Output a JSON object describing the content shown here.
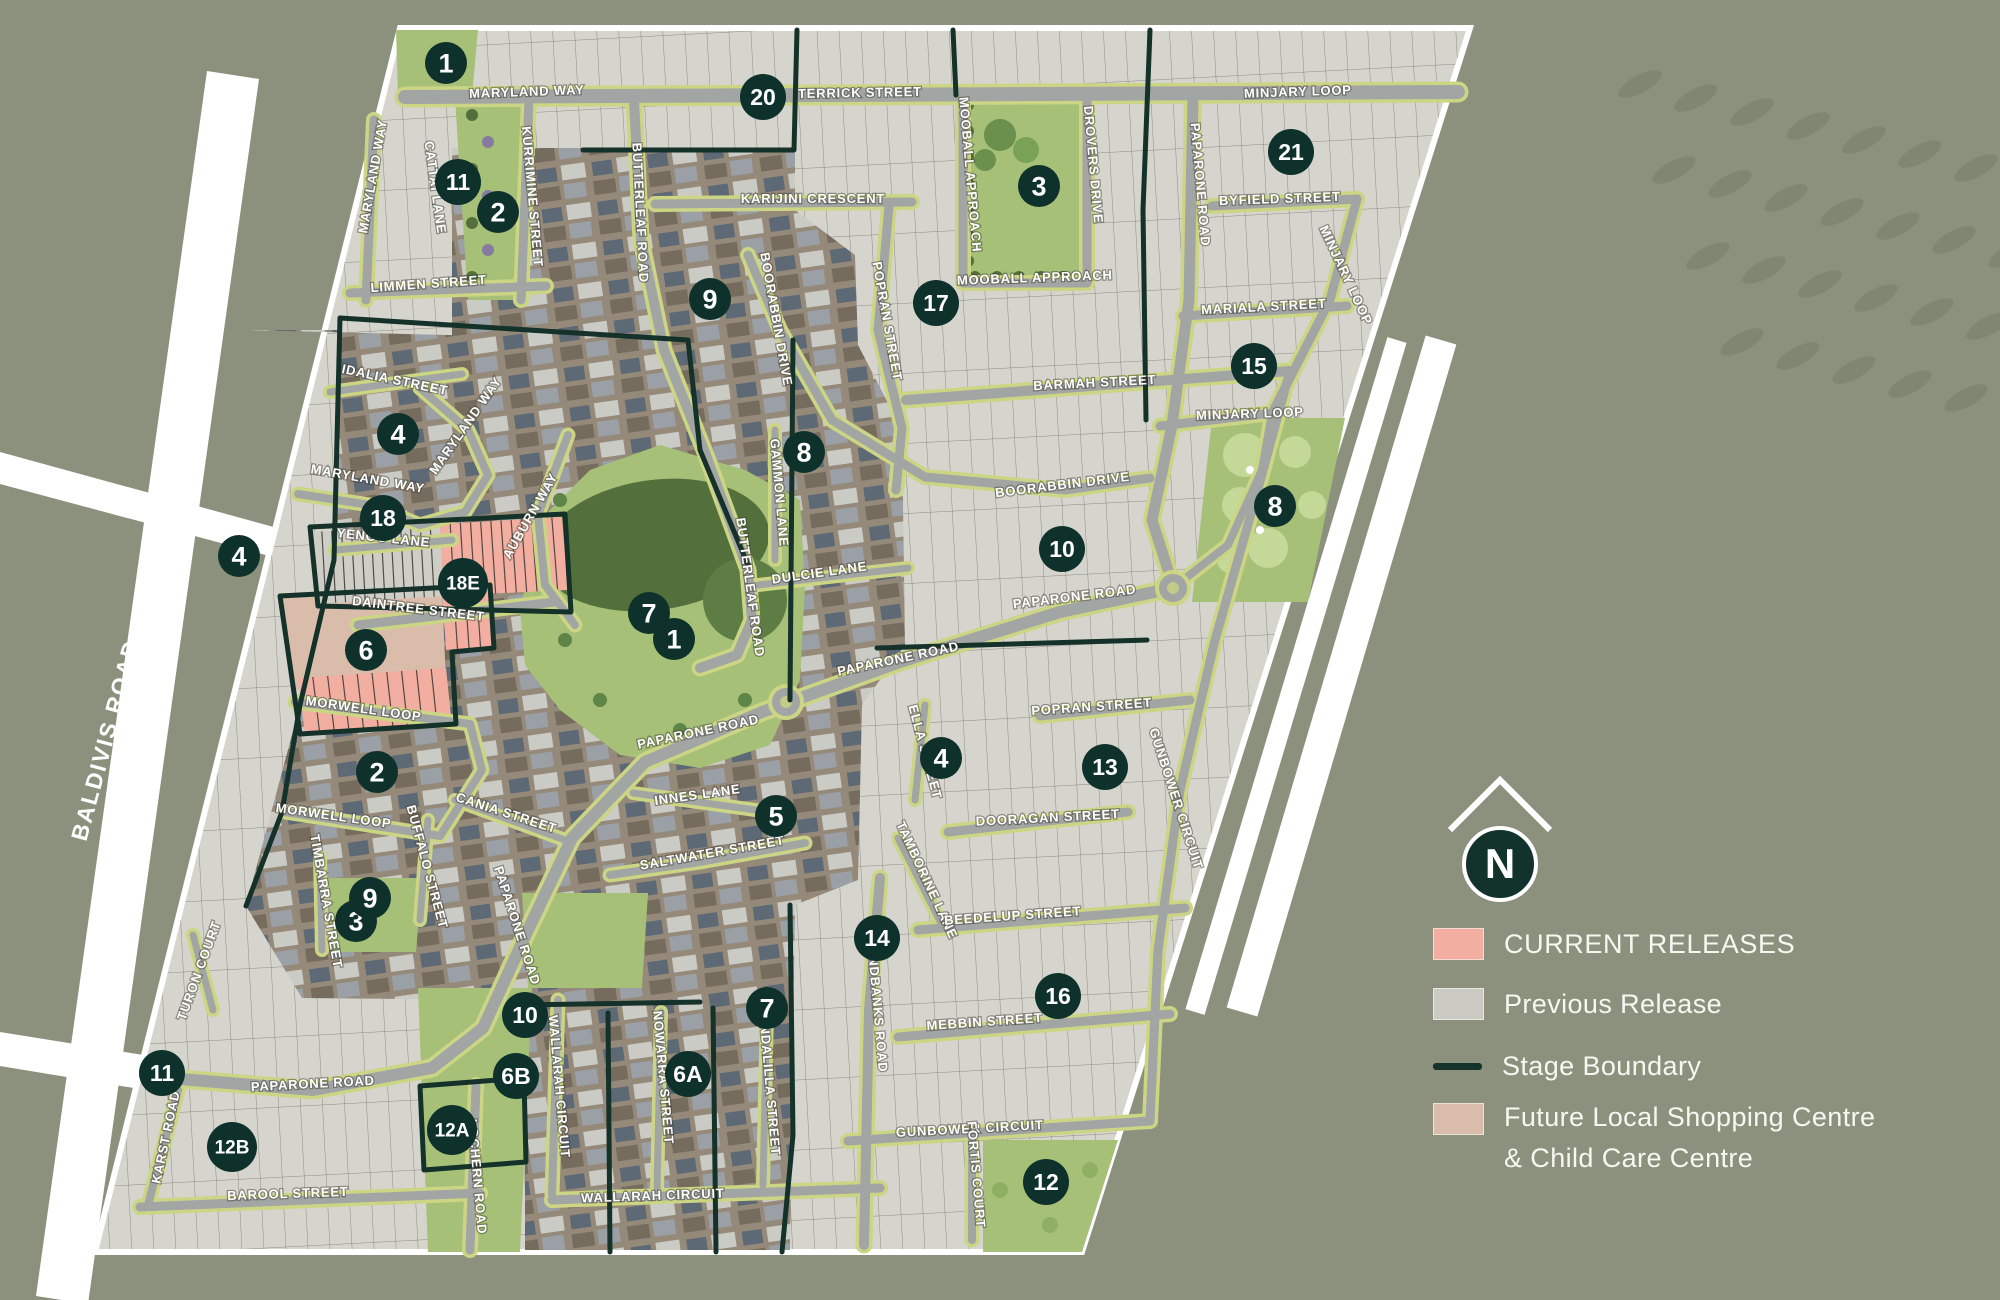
{
  "legend": {
    "items": [
      {
        "label": "CURRENT RELEASES",
        "color": "#F2AEA0",
        "type": "fill"
      },
      {
        "label": "Previous Release",
        "color": "#CBCBC3",
        "type": "fill"
      },
      {
        "label": "Stage Boundary",
        "color": "#16332B",
        "type": "line"
      },
      {
        "line1": "Future Local Shopping Centre",
        "line2": "& Child Care Centre",
        "color": "#D9BCA9",
        "type": "fill"
      }
    ]
  },
  "compass": {
    "letter": "N"
  },
  "external_roads": [
    {
      "label": "BALDIVIS ROAD",
      "x": 113,
      "y": 742,
      "r": -75
    },
    {
      "label": "KWINANA FREEWAY",
      "x": 1333,
      "y": 718,
      "r": -72
    }
  ],
  "map": {
    "streets": [
      {
        "label": "MARYLAND WAY",
        "x": 527,
        "y": 96,
        "r": -2
      },
      {
        "label": "TERRICK STREET",
        "x": 860,
        "y": 97,
        "r": -1
      },
      {
        "label": "MINJARY LOOP",
        "x": 1298,
        "y": 96,
        "r": -2
      },
      {
        "label": "MARYLAND WAY",
        "x": 377,
        "y": 177,
        "r": -80
      },
      {
        "label": "CATTAI LANE",
        "x": 431,
        "y": 188,
        "r": 82
      },
      {
        "label": "KURRIMINE STREET",
        "x": 528,
        "y": 197,
        "r": 85
      },
      {
        "label": "BUTTERLEAF ROAD",
        "x": 636,
        "y": 213,
        "r": 87
      },
      {
        "label": "LIMMEN STREET",
        "x": 429,
        "y": 288,
        "r": -4
      },
      {
        "label": "KARIJINI CRESCENT",
        "x": 813,
        "y": 203,
        "r": 0
      },
      {
        "label": "MOOBALL APPROACH",
        "x": 966,
        "y": 175,
        "r": 85
      },
      {
        "label": "DROVERS DRIVE",
        "x": 1089,
        "y": 165,
        "r": 85
      },
      {
        "label": "PAPARONE ROAD",
        "x": 1196,
        "y": 185,
        "r": 85
      },
      {
        "label": "MOOBALL APPROACH",
        "x": 1035,
        "y": 282,
        "r": -2
      },
      {
        "label": "BYFIELD STREET",
        "x": 1280,
        "y": 203,
        "r": -2
      },
      {
        "label": "MARIALA STREET",
        "x": 1264,
        "y": 311,
        "r": -3
      },
      {
        "label": "MINJARY LOOP",
        "x": 1342,
        "y": 277,
        "r": 65
      },
      {
        "label": "BARMAH STREET",
        "x": 1095,
        "y": 387,
        "r": -3
      },
      {
        "label": "MINJARY LOOP",
        "x": 1250,
        "y": 418,
        "r": -2
      },
      {
        "label": "POPRAN STREET",
        "x": 883,
        "y": 322,
        "r": 80
      },
      {
        "label": "BOORABBIN DRIVE",
        "x": 772,
        "y": 320,
        "r": 80
      },
      {
        "label": "BOORABBIN DRIVE",
        "x": 1063,
        "y": 489,
        "r": -7
      },
      {
        "label": "GAMMON LANE",
        "x": 775,
        "y": 493,
        "r": 85
      },
      {
        "label": "DULCIE LANE",
        "x": 820,
        "y": 577,
        "r": -8
      },
      {
        "label": "PAPARONE ROAD",
        "x": 1075,
        "y": 601,
        "r": -7
      },
      {
        "label": "BUTTERLEAF ROAD",
        "x": 746,
        "y": 588,
        "r": 82
      },
      {
        "label": "IDALIA STREET",
        "x": 394,
        "y": 384,
        "r": 12
      },
      {
        "label": "MARYLAND WAY",
        "x": 469,
        "y": 428,
        "r": -55
      },
      {
        "label": "MARYLAND WAY",
        "x": 367,
        "y": 483,
        "r": 10
      },
      {
        "label": "AUBURN WAY",
        "x": 534,
        "y": 518,
        "r": -60
      },
      {
        "label": "YENGO LANE",
        "x": 383,
        "y": 542,
        "r": 6
      },
      {
        "label": "DAINTREE STREET",
        "x": 418,
        "y": 613,
        "r": 7
      },
      {
        "label": "PAPARONE ROAD",
        "x": 899,
        "y": 663,
        "r": -12
      },
      {
        "label": "POPRAN STREET",
        "x": 1092,
        "y": 711,
        "r": -4
      },
      {
        "label": "PAPARONE ROAD",
        "x": 699,
        "y": 736,
        "r": -12
      },
      {
        "label": "INNES LANE",
        "x": 698,
        "y": 799,
        "r": -8
      },
      {
        "label": "ELLA STREET",
        "x": 921,
        "y": 753,
        "r": 75
      },
      {
        "label": "DOORAGAN STREET",
        "x": 1048,
        "y": 822,
        "r": -3
      },
      {
        "label": "MORWELL LOOP",
        "x": 363,
        "y": 713,
        "r": 8
      },
      {
        "label": "MORWELL LOOP",
        "x": 333,
        "y": 820,
        "r": 8
      },
      {
        "label": "CANIA STREET",
        "x": 505,
        "y": 817,
        "r": 18
      },
      {
        "label": "TIMBARRA STREET",
        "x": 322,
        "y": 902,
        "r": 80
      },
      {
        "label": "BUFFALO STREET",
        "x": 423,
        "y": 868,
        "r": 75
      },
      {
        "label": "SALTWATER STREET",
        "x": 713,
        "y": 857,
        "r": -10
      },
      {
        "label": "PAPARONE ROAD",
        "x": 513,
        "y": 927,
        "r": 72
      },
      {
        "label": "TAMBORINE LANE",
        "x": 923,
        "y": 882,
        "r": 65
      },
      {
        "label": "BEEDELUP STREET",
        "x": 1013,
        "y": 920,
        "r": -4
      },
      {
        "label": "SANDBANKS ROAD",
        "x": 873,
        "y": 1005,
        "r": 85
      },
      {
        "label": "MEBBIN STREET",
        "x": 985,
        "y": 1026,
        "r": -4
      },
      {
        "label": "TURON COURT",
        "x": 203,
        "y": 972,
        "r": -70
      },
      {
        "label": "PAPARONE ROAD",
        "x": 313,
        "y": 1088,
        "r": -3
      },
      {
        "label": "KARST ROAD",
        "x": 170,
        "y": 1138,
        "r": -78
      },
      {
        "label": "WALLARAH CIRCUIT",
        "x": 555,
        "y": 1087,
        "r": 85
      },
      {
        "label": "NOWARRA STREET",
        "x": 659,
        "y": 1078,
        "r": 85
      },
      {
        "label": "KONDALILLA STREET",
        "x": 765,
        "y": 1080,
        "r": 85
      },
      {
        "label": "LOCHERN ROAD",
        "x": 473,
        "y": 1177,
        "r": 85
      },
      {
        "label": "BAROOL STREET",
        "x": 288,
        "y": 1198,
        "r": -2
      },
      {
        "label": "WALLARAH CIRCUIT",
        "x": 653,
        "y": 1200,
        "r": -2
      },
      {
        "label": "GUNBOWER CIRCUIT",
        "x": 970,
        "y": 1133,
        "r": -3
      },
      {
        "label": "GUNBOWER CIRCUIT",
        "x": 1172,
        "y": 800,
        "r": 72
      },
      {
        "label": "FORTIS COURT",
        "x": 972,
        "y": 1175,
        "r": 85
      }
    ],
    "stages": [
      {
        "label": "1",
        "x": 446,
        "y": 63
      },
      {
        "label": "11",
        "x": 458,
        "y": 182
      },
      {
        "label": "2",
        "x": 498,
        "y": 212
      },
      {
        "label": "20",
        "x": 763,
        "y": 97
      },
      {
        "label": "3",
        "x": 1039,
        "y": 186
      },
      {
        "label": "21",
        "x": 1291,
        "y": 152
      },
      {
        "label": "17",
        "x": 936,
        "y": 303
      },
      {
        "label": "9",
        "x": 710,
        "y": 299
      },
      {
        "label": "15",
        "x": 1254,
        "y": 366
      },
      {
        "label": "8",
        "x": 804,
        "y": 452
      },
      {
        "label": "8",
        "x": 1275,
        "y": 506
      },
      {
        "label": "4",
        "x": 398,
        "y": 434
      },
      {
        "label": "18",
        "x": 383,
        "y": 518
      },
      {
        "label": "18E",
        "x": 463,
        "y": 583
      },
      {
        "label": "4",
        "x": 239,
        "y": 556
      },
      {
        "label": "6",
        "x": 366,
        "y": 650
      },
      {
        "label": "7",
        "x": 649,
        "y": 613
      },
      {
        "label": "1",
        "x": 674,
        "y": 639
      },
      {
        "label": "10",
        "x": 1062,
        "y": 549
      },
      {
        "label": "2",
        "x": 377,
        "y": 772
      },
      {
        "label": "3",
        "x": 356,
        "y": 921
      },
      {
        "label": "9",
        "x": 370,
        "y": 898
      },
      {
        "label": "4",
        "x": 941,
        "y": 758
      },
      {
        "label": "13",
        "x": 1105,
        "y": 767
      },
      {
        "label": "5",
        "x": 776,
        "y": 816
      },
      {
        "label": "14",
        "x": 877,
        "y": 938
      },
      {
        "label": "16",
        "x": 1058,
        "y": 996
      },
      {
        "label": "7",
        "x": 767,
        "y": 1008
      },
      {
        "label": "10",
        "x": 525,
        "y": 1015
      },
      {
        "label": "6B",
        "x": 516,
        "y": 1076
      },
      {
        "label": "6A",
        "x": 688,
        "y": 1074
      },
      {
        "label": "12A",
        "x": 452,
        "y": 1130
      },
      {
        "label": "12B",
        "x": 232,
        "y": 1147
      },
      {
        "label": "11",
        "x": 162,
        "y": 1073
      },
      {
        "label": "12",
        "x": 1046,
        "y": 1182
      }
    ]
  },
  "colors": {
    "background": "#8C917D",
    "estate": "#D6D5CD",
    "lot_line": "#6E6B61",
    "aerial": "#95897A",
    "road": "#A1A5A3",
    "verge": "#CCD584",
    "boundary": "#14312A",
    "marker": "#0E322B",
    "park": "#A6C078",
    "park_dark": "#53703C",
    "park_light": "#C4D897",
    "pink": "#F2AEA0",
    "tan": "#D9BCA9",
    "purple": "#857AA0",
    "white": "#FFFFFF",
    "label_text": "#FFFFFF",
    "legend_text": "#F7F7F2"
  }
}
